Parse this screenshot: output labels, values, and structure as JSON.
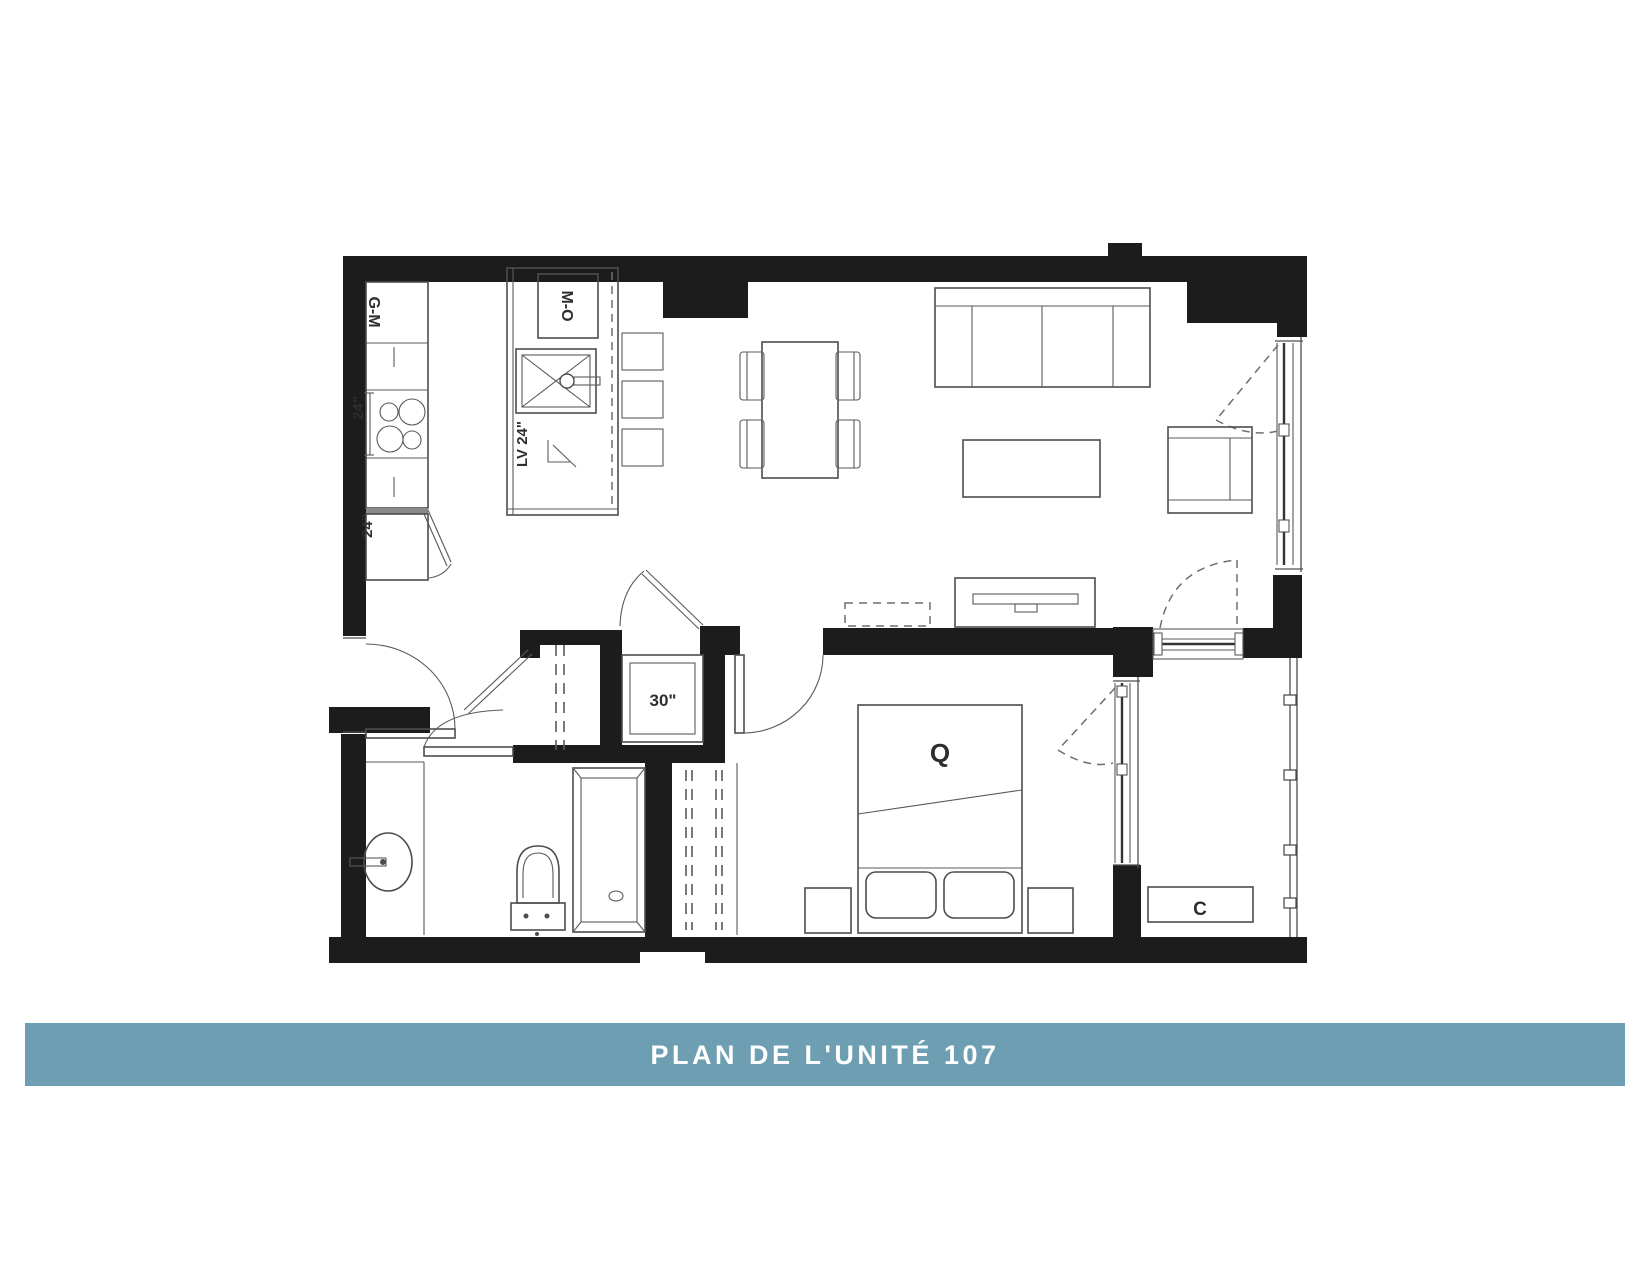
{
  "banner": {
    "title": "PLAN DE L'UNITÉ 107",
    "bg": "#6e9eb2",
    "fg": "#ffffff"
  },
  "plan": {
    "kitchen": {
      "pantry_label": "G-M",
      "counter_width_label": "24\"",
      "lower_cabinet_label": "24\"",
      "microwave_oven_label": "M-O",
      "dishwasher_label": "LV 24\""
    },
    "laundry_closet": {
      "width_label": "30\""
    },
    "bedroom": {
      "bed_label": "Q"
    },
    "balcony": {
      "unit_label": "C"
    },
    "colors": {
      "wall": "#1c1c1c",
      "furniture_line": "#4d4d4d"
    }
  }
}
